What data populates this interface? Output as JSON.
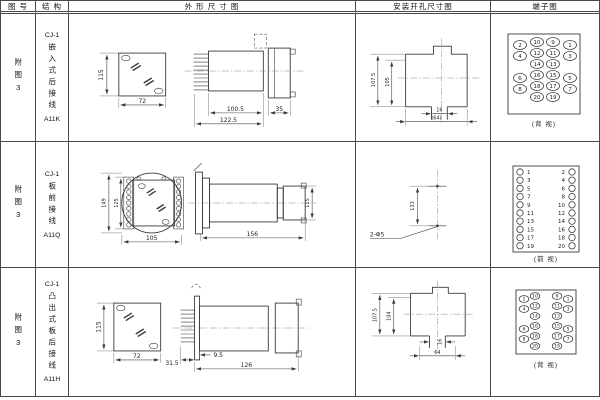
{
  "header": {
    "figure": "图 号",
    "structure": "结 构",
    "outline": "外 形 尺 寸 图",
    "mounting": "安装开孔尺寸图",
    "terminal": "端子图"
  },
  "rows": [
    {
      "figure": "附图3",
      "model": "CJ-1",
      "structure": "嵌入式后接线",
      "code": "A11K",
      "dims": {
        "front_h": "115",
        "front_w": "72",
        "len1": "100.5",
        "len2": "122.5",
        "len3": "35",
        "mount_h1": "107.5",
        "mount_h2": "105",
        "mount_notch": "16",
        "mount_w": "(64)"
      },
      "terminal_caption": "(背 视)"
    },
    {
      "figure": "附图3",
      "model": "CJ-1",
      "structure": "板前接线",
      "code": "A11Q",
      "dims": {
        "front_h1": "149",
        "front_h2": "125",
        "front_w": "105",
        "side_len": "156",
        "side_h": "115",
        "mount_h": "133",
        "mount_holes": "2-Φ5"
      },
      "terminal_caption": "(前 视)"
    },
    {
      "figure": "附图3",
      "model": "CJ-1",
      "structure": "凸出式板后接线",
      "code": "A11H",
      "dims": {
        "front_h": "115",
        "front_w": "72",
        "len1": "31.5",
        "len2": "9.5",
        "len3": "126",
        "mount_h1": "107.5",
        "mount_h2": "104",
        "mount_notch": "16",
        "mount_w": "64"
      },
      "terminal_caption": "(背 视)"
    }
  ],
  "terminals": {
    "row1": {
      "rx": 6.5,
      "ry": 4.5,
      "font": 5.5,
      "items": [
        {
          "x": 29,
          "y": 31,
          "n": "2"
        },
        {
          "x": 29,
          "y": 42,
          "n": "4"
        },
        {
          "x": 29,
          "y": 64,
          "n": "6"
        },
        {
          "x": 29,
          "y": 75,
          "n": "8"
        },
        {
          "x": 46,
          "y": 28,
          "n": "10"
        },
        {
          "x": 46,
          "y": 39,
          "n": "12"
        },
        {
          "x": 46,
          "y": 50,
          "n": "14"
        },
        {
          "x": 46,
          "y": 61,
          "n": "16"
        },
        {
          "x": 46,
          "y": 72,
          "n": "18"
        },
        {
          "x": 46,
          "y": 83,
          "n": "20"
        },
        {
          "x": 62,
          "y": 28,
          "n": "9"
        },
        {
          "x": 62,
          "y": 39,
          "n": "11"
        },
        {
          "x": 62,
          "y": 50,
          "n": "13"
        },
        {
          "x": 62,
          "y": 61,
          "n": "15"
        },
        {
          "x": 62,
          "y": 72,
          "n": "17"
        },
        {
          "x": 62,
          "y": 83,
          "n": "19"
        },
        {
          "x": 79,
          "y": 31,
          "n": "1"
        },
        {
          "x": 79,
          "y": 42,
          "n": "3"
        },
        {
          "x": 79,
          "y": 64,
          "n": "5"
        },
        {
          "x": 79,
          "y": 75,
          "n": "7"
        }
      ]
    },
    "row2": {
      "rx": 3.2,
      "ry": 3.2,
      "font": 5.5,
      "items": [
        {
          "x": 29,
          "y": 30,
          "n": "1",
          "tx": 36,
          "a": "start"
        },
        {
          "x": 29,
          "y": 38.2,
          "n": "3",
          "tx": 36,
          "a": "start"
        },
        {
          "x": 29,
          "y": 46.4,
          "n": "5",
          "tx": 36,
          "a": "start"
        },
        {
          "x": 29,
          "y": 54.6,
          "n": "7",
          "tx": 36,
          "a": "start"
        },
        {
          "x": 29,
          "y": 62.8,
          "n": "9",
          "tx": 36,
          "a": "start"
        },
        {
          "x": 29,
          "y": 71,
          "n": "11",
          "tx": 36,
          "a": "start"
        },
        {
          "x": 29,
          "y": 79.2,
          "n": "13",
          "tx": 36,
          "a": "start"
        },
        {
          "x": 29,
          "y": 87.4,
          "n": "15",
          "tx": 36,
          "a": "start"
        },
        {
          "x": 29,
          "y": 95.6,
          "n": "17",
          "tx": 36,
          "a": "start"
        },
        {
          "x": 29,
          "y": 103.8,
          "n": "19",
          "tx": 36,
          "a": "start"
        },
        {
          "x": 81,
          "y": 30,
          "n": "2",
          "tx": 74,
          "a": "end"
        },
        {
          "x": 81,
          "y": 38.2,
          "n": "4",
          "tx": 74,
          "a": "end"
        },
        {
          "x": 81,
          "y": 46.4,
          "n": "6",
          "tx": 74,
          "a": "end"
        },
        {
          "x": 81,
          "y": 54.6,
          "n": "8",
          "tx": 74,
          "a": "end"
        },
        {
          "x": 81,
          "y": 62.8,
          "n": "10",
          "tx": 74,
          "a": "end"
        },
        {
          "x": 81,
          "y": 71,
          "n": "12",
          "tx": 74,
          "a": "end"
        },
        {
          "x": 81,
          "y": 79.2,
          "n": "14",
          "tx": 74,
          "a": "end"
        },
        {
          "x": 81,
          "y": 87.4,
          "n": "16",
          "tx": 74,
          "a": "end"
        },
        {
          "x": 81,
          "y": 95.6,
          "n": "18",
          "tx": 74,
          "a": "end"
        },
        {
          "x": 81,
          "y": 103.8,
          "n": "20",
          "tx": 74,
          "a": "end"
        }
      ]
    },
    "row3": {
      "rx": 4.8,
      "ry": 3.4,
      "font": 4.5,
      "items": [
        {
          "x": 33,
          "y": 31,
          "n": "2"
        },
        {
          "x": 33,
          "y": 41,
          "n": "4"
        },
        {
          "x": 33,
          "y": 61,
          "n": "6"
        },
        {
          "x": 33,
          "y": 71,
          "n": "8"
        },
        {
          "x": 44,
          "y": 28,
          "n": "10"
        },
        {
          "x": 44,
          "y": 38,
          "n": "12"
        },
        {
          "x": 44,
          "y": 48,
          "n": "14"
        },
        {
          "x": 44,
          "y": 58,
          "n": "16"
        },
        {
          "x": 44,
          "y": 68,
          "n": "18"
        },
        {
          "x": 44,
          "y": 78,
          "n": "20"
        },
        {
          "x": 66,
          "y": 28,
          "n": "9"
        },
        {
          "x": 66,
          "y": 38,
          "n": "11"
        },
        {
          "x": 66,
          "y": 48,
          "n": "13"
        },
        {
          "x": 66,
          "y": 58,
          "n": "15"
        },
        {
          "x": 66,
          "y": 68,
          "n": "17"
        },
        {
          "x": 66,
          "y": 78,
          "n": "19"
        },
        {
          "x": 77,
          "y": 31,
          "n": "1"
        },
        {
          "x": 77,
          "y": 41,
          "n": "3"
        },
        {
          "x": 77,
          "y": 61,
          "n": "5"
        },
        {
          "x": 77,
          "y": 71,
          "n": "7"
        }
      ]
    }
  }
}
